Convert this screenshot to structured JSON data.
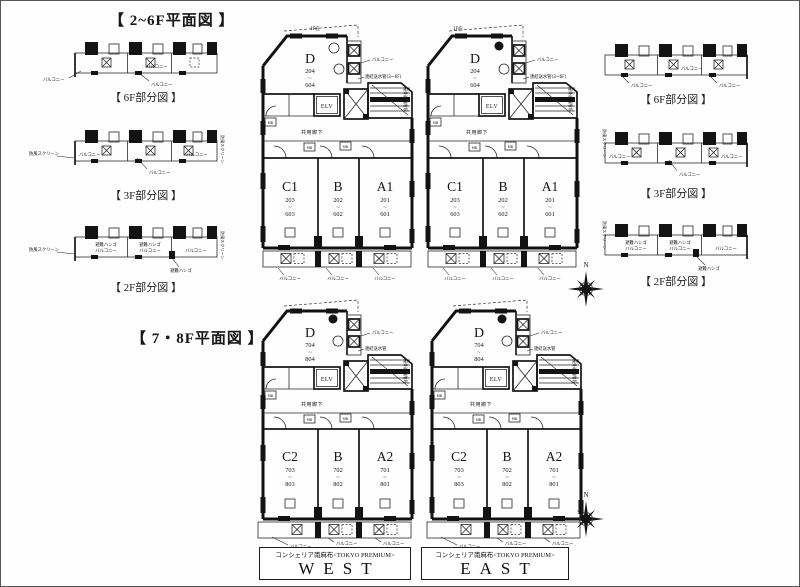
{
  "titles": {
    "upper": "【 2~6F平面図 】",
    "lower": "【 7・8F平面図 】"
  },
  "captions": {
    "f6": "【 6F部分図 】",
    "f3": "【 3F部分図 】",
    "f2": "【 2F部分図 】"
  },
  "annotations": {
    "balcony": "バルコニー",
    "windscreen": "防風スクリーン",
    "escape_ladder": "避難ハシゴ",
    "canopy": "1F庇",
    "standpipe_2_6": "連結送水管(3~6F)",
    "standpipe_7_8": "連結送水管",
    "outdoor_stairs": "屋外避難階段",
    "elevator": "ELV",
    "corridor": "共用廊下",
    "meter_box": "MB",
    "north": "N"
  },
  "range_separator": "~",
  "units_2_6": {
    "d": {
      "label": "D",
      "from": "204",
      "to": "604"
    },
    "c1": {
      "label": "C1",
      "from": "203",
      "to": "603"
    },
    "b": {
      "label": "B",
      "from": "202",
      "to": "602"
    },
    "a1": {
      "label": "A1",
      "from": "201",
      "to": "601"
    }
  },
  "units_7_8": {
    "d": {
      "label": "D",
      "from": "704",
      "to": "804"
    },
    "c2": {
      "label": "C2",
      "from": "703",
      "to": "803"
    },
    "b": {
      "label": "B",
      "from": "702",
      "to": "802"
    },
    "a2": {
      "label": "A2",
      "from": "701",
      "to": "801"
    }
  },
  "footer": {
    "west": {
      "brand": "コンシェリア南麻布<TOKYO PREMIUM>",
      "name": "WEST"
    },
    "east": {
      "brand": "コンシェリア南麻布<TOKYO PREMIUM>",
      "name": "EAST"
    }
  },
  "colors": {
    "ink": "#141414",
    "paper": "#fefefe"
  }
}
